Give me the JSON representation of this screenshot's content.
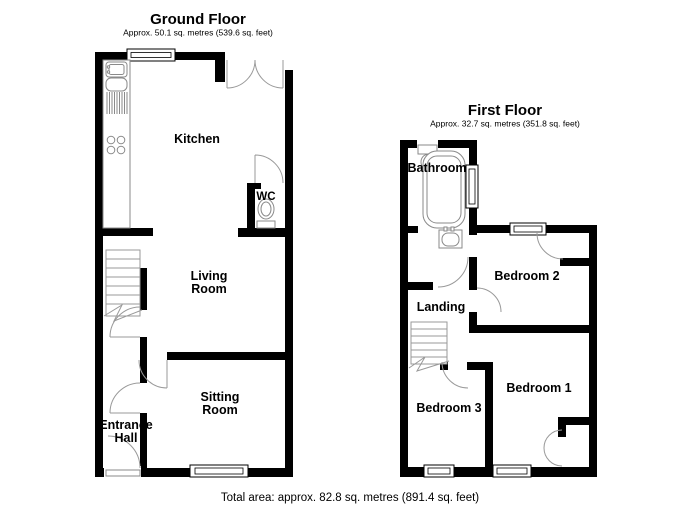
{
  "ground_floor": {
    "title": "Ground Floor",
    "area": "Approx. 50.1 sq. metres (539.6 sq. feet)",
    "rooms": [
      {
        "name": "Kitchen",
        "lines": [
          "Kitchen"
        ]
      },
      {
        "name": "WC",
        "lines": [
          "WC"
        ]
      },
      {
        "name": "Living Room",
        "lines": [
          "Living",
          "Room"
        ]
      },
      {
        "name": "Sitting Room",
        "lines": [
          "Sitting",
          "Room"
        ]
      },
      {
        "name": "Entrance Hall",
        "lines": [
          "Entrance",
          "Hall"
        ]
      }
    ]
  },
  "first_floor": {
    "title": "First Floor",
    "area": "Approx. 32.7 sq. metres (351.8 sq. feet)",
    "rooms": [
      {
        "name": "Bathroom",
        "lines": [
          "Bathroom"
        ]
      },
      {
        "name": "Landing",
        "lines": [
          "Landing"
        ]
      },
      {
        "name": "Bedroom 2",
        "lines": [
          "Bedroom 2"
        ]
      },
      {
        "name": "Bedroom 1",
        "lines": [
          "Bedroom 1"
        ]
      },
      {
        "name": "Bedroom 3",
        "lines": [
          "Bedroom 3"
        ]
      }
    ]
  },
  "footer": {
    "total_area": "Total area: approx. 82.8 sq. metres (891.4 sq. feet)"
  },
  "colors": {
    "wall": "#000000",
    "door_arc": "#999999",
    "fixture": "#8a8a8a",
    "background": "#ffffff"
  }
}
